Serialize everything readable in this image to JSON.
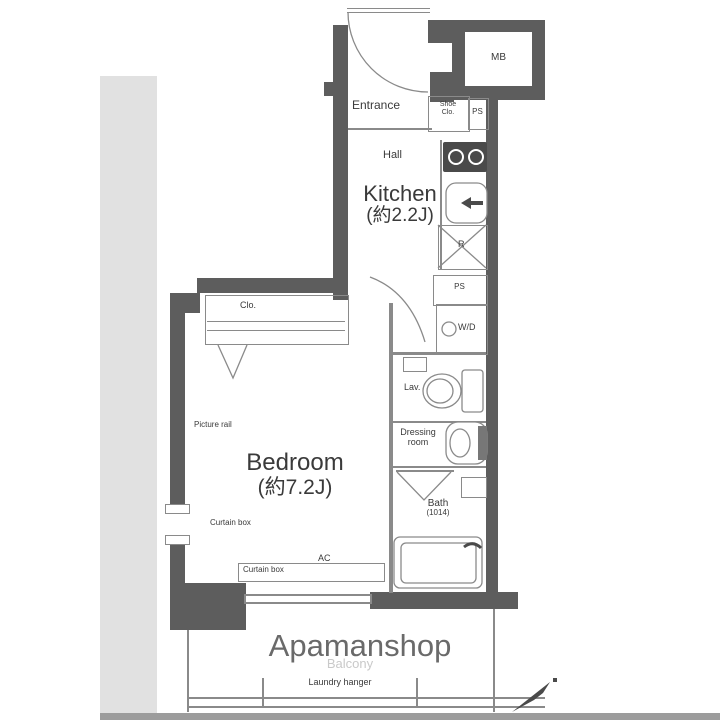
{
  "plan": {
    "source_watermark": "Apamanshop",
    "rooms": {
      "kitchen": {
        "name": "Kitchen",
        "size": "(約2.2J)"
      },
      "bedroom": {
        "name": "Bedroom",
        "size": "(約7.2J)"
      },
      "bath": {
        "name": "Bath",
        "size": "(1014)"
      },
      "entrance": {
        "name": "Entrance"
      },
      "hall": {
        "name": "Hall"
      },
      "lavatory": {
        "name": "Lav."
      },
      "dressing": {
        "line1": "Dressing",
        "line2": "room"
      },
      "balcony": {
        "name": "Balcony"
      }
    },
    "labels": {
      "mb": "MB",
      "shoe_closet_line1": "Shoe",
      "shoe_closet_line2": "Clo.",
      "ps_top": "PS",
      "ps_mid": "PS",
      "washer_dryer": "W/D",
      "refrigerator": "R",
      "closet": "Clo.",
      "picture_rail": "Picture rail",
      "curtain_box_left": "Curtain box",
      "curtain_box_bottom": "Curtain box",
      "ac": "AC",
      "laundry_hanger": "Laundry hanger"
    },
    "colors": {
      "background": "#ffffff",
      "wall": "#5d5d5d",
      "thin_line": "#8a8a8a",
      "text": "#3a3a3a",
      "watermark": "#6a6a6a",
      "faint_text": "#c9c9c9",
      "photo_edge": "#e1e1e1",
      "photo_edge_dark": "#9c9c9c",
      "fixture_dark": "#4a4a4a"
    }
  }
}
